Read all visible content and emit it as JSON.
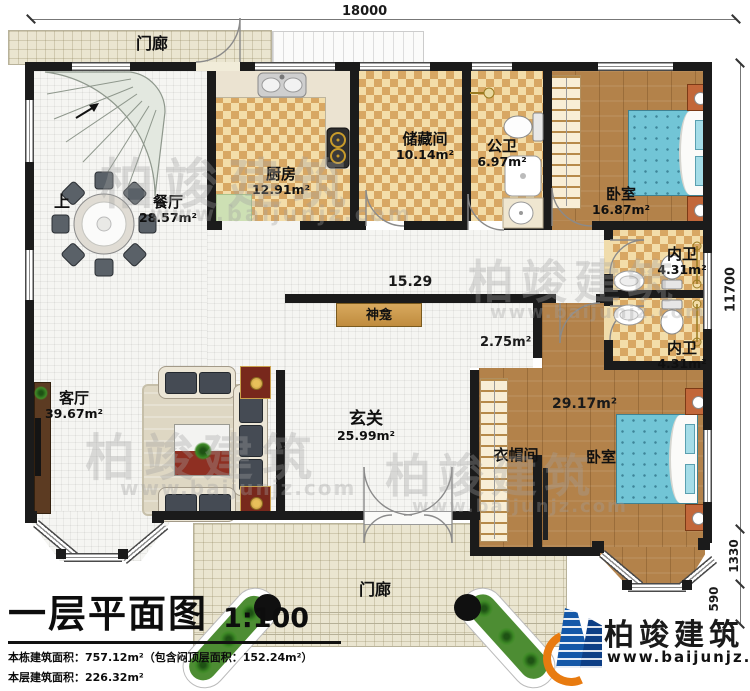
{
  "plan": {
    "title": "一层平面图",
    "scale": "1:100",
    "stats": [
      "本栋建筑面积：757.12m²（包含闷顶层面积：152.24m²）",
      "本层建筑面积：226.32m²",
      "建筑占地面积：226.32m²　　层高：3.6m"
    ]
  },
  "dimensions": {
    "top_width": "18000",
    "right_height": "11700",
    "right_bay": "1330",
    "right_porch": "590",
    "corridor_length": "15.29",
    "passage_area": "2.75m²"
  },
  "rooms": {
    "porch_top": {
      "name": "门廊"
    },
    "porch_bottom": {
      "name": "门廊"
    },
    "kitchen": {
      "name": "厨房",
      "area": "12.91m²"
    },
    "storage": {
      "name": "储藏间",
      "area": "10.14m²"
    },
    "public_bath": {
      "name": "公卫",
      "area": "6.97m²"
    },
    "bedroom_top": {
      "name": "卧室",
      "area": "16.87m²"
    },
    "dining": {
      "name": "餐厅",
      "area": "28.57m²"
    },
    "living": {
      "name": "客厅",
      "area": "39.67m²"
    },
    "foyer": {
      "name": "玄关",
      "area": "25.99m²"
    },
    "shrine": {
      "name": "神龛"
    },
    "inner_bath_top": {
      "name": "内卫",
      "area": "4.31m²"
    },
    "inner_bath_bottom": {
      "name": "内卫",
      "area": "4.31m²"
    },
    "cloakroom": {
      "name": "衣帽间"
    },
    "bedroom_bottom": {
      "name": "卧室",
      "area": "29.17m²"
    },
    "stair": {
      "direction_label": "上"
    }
  },
  "branding": {
    "company": "柏竣建筑",
    "website": "www.baijunjz.com"
  },
  "watermark": {
    "text": "柏竣建筑",
    "site": "www.baijunjz.com"
  },
  "legend_colors": {
    "wall": "#1b1b1b",
    "checker_tile": "#d8a763",
    "wood_floor": "#b3824a",
    "bed": "#72c5d6",
    "porch_tile": "#eae5d0",
    "brand_blue": "#1458a8",
    "brand_orange": "#e87b10"
  }
}
